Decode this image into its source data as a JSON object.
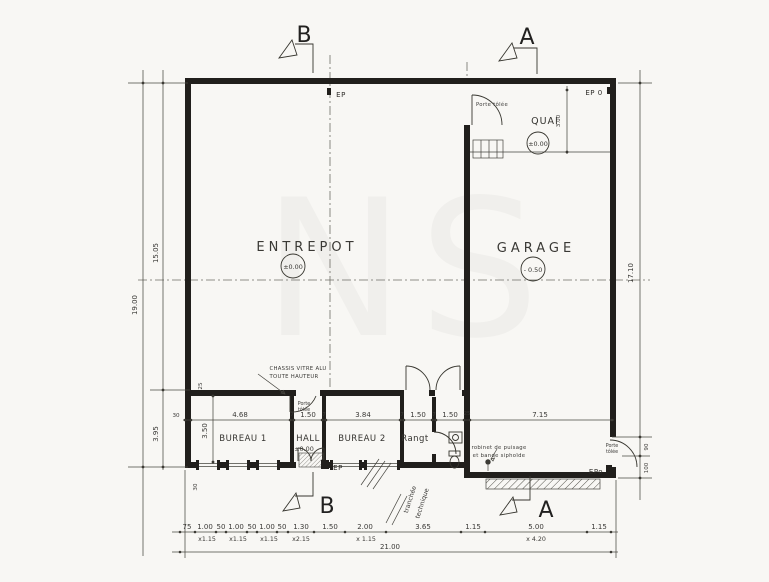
{
  "watermark": "NS",
  "rooms": {
    "entrepot": {
      "name": "ENTREPOT",
      "level": "±0.00"
    },
    "garage": {
      "name": "GARAGE",
      "level": "- 0.50"
    },
    "quai": {
      "name": "QUAI",
      "level": "±0.00"
    },
    "bureau1": {
      "name": "BUREAU 1"
    },
    "hall": {
      "name": "HALL",
      "level": "±0.00"
    },
    "bureau2": {
      "name": "BUREAU 2"
    },
    "rangt": {
      "name": "Rangt"
    }
  },
  "sections": {
    "top_b": "B",
    "top_a": "A",
    "bottom_b": "B",
    "bottom_a": "A"
  },
  "ep": {
    "top": "EP",
    "top_right": "EP 0",
    "hall": "EP",
    "garage": "EPo"
  },
  "ann": {
    "chassis_1": "CHASSIS VITRE ALU",
    "chassis_2": "TOUTE HAUTEUR",
    "porte_quai": "Porte tôlée",
    "porte_hall_1": "Porte",
    "porte_hall_2": "tôlée",
    "porte_garage_1": "Porte",
    "porte_garage_2": "tôlée",
    "robinet_1": "robinet de puisage",
    "robinet_2": "et bande siphoïde",
    "tranchee_1": "tranchée",
    "tranchee_2": "technique"
  },
  "dims": {
    "left_outer": "19.00",
    "left_upper": "15.05",
    "left_lower": "3.95",
    "right_main": "17.10",
    "right_a": "90",
    "right_b": "100",
    "quai_depth": "3.00",
    "bureau_depth": "3.50",
    "wall_25": "25",
    "wall_30_left": "30",
    "wall_30_bottom": "30",
    "row_interior": [
      "30",
      "4.68",
      "7",
      "1.50",
      "7",
      "3.84",
      "7",
      "1.50",
      "7",
      "1.50",
      "25",
      "7.15"
    ],
    "row_facade": [
      "75",
      "1.00",
      "50",
      "1.00",
      "50",
      "1.00",
      "50",
      "1.30",
      "1.50",
      "2.00",
      "3.65",
      "1.15",
      "5.00",
      "1.15"
    ],
    "row_facade_sub": [
      "x1.15",
      "x1.15",
      "x1.15",
      "x2.15",
      "x 1.15",
      "x 4.20"
    ],
    "total": "21.00"
  }
}
